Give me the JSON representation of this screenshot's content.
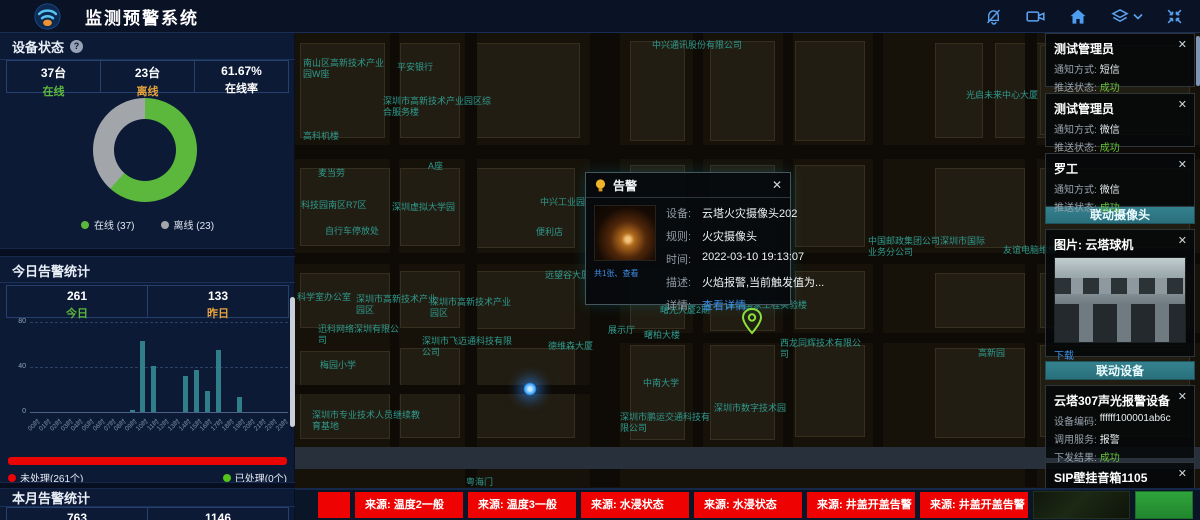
{
  "colors": {
    "accent_teal": "#31808d",
    "alert_red": "#ee0202",
    "success_green": "#67c23a",
    "warning_orange": "#e6a23c",
    "online_green": "#5cb83d",
    "offline_gray": "#a2a6aa",
    "link_blue": "#3d8fe8"
  },
  "header": {
    "title": "监测预警系统",
    "icons": [
      "bell-off-icon",
      "video-camera-icon",
      "home-icon",
      "layers-icon",
      "fullscreen-icon"
    ]
  },
  "left_panel": {
    "device_status": {
      "title": "设备状态",
      "stats": [
        {
          "value": "37台",
          "label": "在线",
          "color": "#5cb83d"
        },
        {
          "value": "23台",
          "label": "离线",
          "color": "#e6a23c"
        },
        {
          "value": "61.67%",
          "label": "在线率",
          "color": "#ffffff"
        }
      ],
      "chart_data": {
        "type": "pie",
        "labels": [
          "在线",
          "离线"
        ],
        "values": [
          37,
          23
        ],
        "colors": [
          "#5cb83d",
          "#a2a6aa"
        ],
        "legend": [
          "在线 (37)",
          "离线 (23)"
        ]
      }
    },
    "today_alarm": {
      "title": "今日告警统计",
      "stats": [
        {
          "value": "261",
          "label": "今日",
          "color": "#5cb83d"
        },
        {
          "value": "133",
          "label": "昨日",
          "color": "#e6a23c"
        }
      ],
      "chart_data": {
        "type": "bar",
        "categories": [
          "00时",
          "01时",
          "02时",
          "03时",
          "04时",
          "05时",
          "06时",
          "07时",
          "08时",
          "09时",
          "10时",
          "11时",
          "12时",
          "13时",
          "14时",
          "15时",
          "16时",
          "17时",
          "18时",
          "19时",
          "20时",
          "21时",
          "22时",
          "23时"
        ],
        "values": [
          0,
          0,
          0,
          0,
          0,
          0,
          0,
          0,
          0,
          2,
          63,
          41,
          0,
          0,
          32,
          37,
          19,
          55,
          0,
          13,
          0,
          0,
          0,
          0
        ],
        "ylim": [
          0,
          80
        ],
        "yticks": [
          0,
          40,
          80
        ],
        "bar_color": "#2f7e89",
        "grid": true
      },
      "progress": {
        "unprocessed_label": "未处理(261个)",
        "processed_label": "已处理(0个)",
        "unprocessed": 261,
        "processed": 0
      }
    },
    "month_alarm": {
      "title": "本月告警统计",
      "stats": [
        {
          "value": "763"
        },
        {
          "value": "1146"
        }
      ]
    }
  },
  "map": {
    "labels": [
      {
        "text": "南山区高新技术产业园W座",
        "x": 303,
        "y": 58,
        "w": 88
      },
      {
        "text": "平安银行",
        "x": 397,
        "y": 62
      },
      {
        "text": "深圳市高新技术产业园区综合服务楼",
        "x": 383,
        "y": 96,
        "w": 108
      },
      {
        "text": "高科机楼",
        "x": 303,
        "y": 131
      },
      {
        "text": "中兴通讯股份有限公司",
        "x": 652,
        "y": 40,
        "w": 95
      },
      {
        "text": "麦当劳",
        "x": 318,
        "y": 168
      },
      {
        "text": "科技园南区R7区",
        "x": 301,
        "y": 200
      },
      {
        "text": "深圳虚拟大学园",
        "x": 392,
        "y": 202
      },
      {
        "text": "自行车停放处",
        "x": 325,
        "y": 226
      },
      {
        "text": "A座",
        "x": 428,
        "y": 161
      },
      {
        "text": "中兴工业园",
        "x": 540,
        "y": 197
      },
      {
        "text": "便利店",
        "x": 536,
        "y": 227
      },
      {
        "text": "光启未来中心大厦",
        "x": 966,
        "y": 90,
        "w": 120
      },
      {
        "text": "远望谷大厦",
        "x": 545,
        "y": 270
      },
      {
        "text": "科学室办公室",
        "x": 297,
        "y": 292
      },
      {
        "text": "深圳市高新技术产业园区",
        "x": 356,
        "y": 294,
        "w": 82
      },
      {
        "text": "深圳市高新技术产业园区",
        "x": 430,
        "y": 297,
        "w": 82
      },
      {
        "text": "迅科网络深圳有限公司",
        "x": 318,
        "y": 324,
        "w": 82
      },
      {
        "text": "深圳市飞迈通科技有限公司",
        "x": 422,
        "y": 336,
        "w": 92
      },
      {
        "text": "梅园小学",
        "x": 320,
        "y": 360
      },
      {
        "text": "深圳市专业技术人员继续教育基地",
        "x": 312,
        "y": 410,
        "w": 112
      },
      {
        "text": "德维森大厦",
        "x": 548,
        "y": 341
      },
      {
        "text": "展示厅",
        "x": 608,
        "y": 325
      },
      {
        "text": "曙柏大楼",
        "x": 644,
        "y": 330
      },
      {
        "text": "曙光大厦2期",
        "x": 660,
        "y": 305
      },
      {
        "text": "中南大学",
        "x": 643,
        "y": 378
      },
      {
        "text": "深圳市数字技术园",
        "x": 714,
        "y": 403
      },
      {
        "text": "深圳市鹏运交通科技有限公司",
        "x": 620,
        "y": 412,
        "w": 98
      },
      {
        "text": "深圳国家工程实验楼",
        "x": 726,
        "y": 300,
        "w": 82
      },
      {
        "text": "西龙同辉技术有限公司",
        "x": 780,
        "y": 338,
        "w": 82
      },
      {
        "text": "中国邮政集团公司深圳市国际业务分公司",
        "x": 868,
        "y": 236,
        "w": 118
      },
      {
        "text": "友谊电脑维修",
        "x": 1003,
        "y": 245
      },
      {
        "text": "高新园",
        "x": 978,
        "y": 348
      },
      {
        "text": "粤海门",
        "x": 466,
        "y": 477
      }
    ],
    "markers": [
      {
        "name": "blue-glow-marker",
        "x": 530,
        "y": 389
      },
      {
        "name": "green-pin-marker",
        "x": 752,
        "y": 333
      }
    ]
  },
  "alert_popup": {
    "title": "告警",
    "thumb_caption": "共1张、查看",
    "rows": [
      {
        "label": "设备:",
        "value": "云塔火灾摄像头202"
      },
      {
        "label": "规则:",
        "value": "火灾摄像头"
      },
      {
        "label": "时间:",
        "value": "2022-03-10 19:13:07"
      },
      {
        "label": "描述:",
        "value": "火焰报警,当前触发值为..."
      }
    ],
    "detail_label": "详情:",
    "detail_link": "查看详情"
  },
  "notifications": [
    {
      "title": "测试管理员",
      "rows": [
        {
          "label": "通知方式:",
          "value": "短信"
        },
        {
          "label": "推送状态:",
          "value": "成功",
          "success": true
        }
      ]
    },
    {
      "title": "测试管理员",
      "rows": [
        {
          "label": "通知方式:",
          "value": "微信"
        },
        {
          "label": "推送状态:",
          "value": "成功",
          "success": true
        }
      ]
    },
    {
      "title": "罗工",
      "rows": [
        {
          "label": "通知方式:",
          "value": "微信"
        },
        {
          "label": "推送状态:",
          "value": "成功",
          "success": true
        }
      ]
    }
  ],
  "linked_camera": {
    "header": "联动摄像头",
    "image_label": "图片: 云塔球机",
    "download_link": "下载"
  },
  "linked_devices": {
    "header": "联动设备",
    "cards": [
      {
        "title": "云塔307声光报警设备",
        "rows": [
          {
            "label": "设备编码:",
            "value": "ffffff100001ab6c"
          },
          {
            "label": "调用服务:",
            "value": "报警"
          },
          {
            "label": "下发结果:",
            "value": "成功",
            "success": true
          }
        ]
      },
      {
        "title": "SIP壁挂音箱1105",
        "rows": [
          {
            "label": "设备编码:",
            "value": "1105"
          }
        ]
      }
    ]
  },
  "bottom_alerts": {
    "items": [
      "来源: 温度2一般",
      "来源: 温度3一般",
      "来源: 水浸状态",
      "来源: 水浸状态",
      "来源: 井盖开盖告警",
      "来源: 井盖开盖告警"
    ]
  }
}
